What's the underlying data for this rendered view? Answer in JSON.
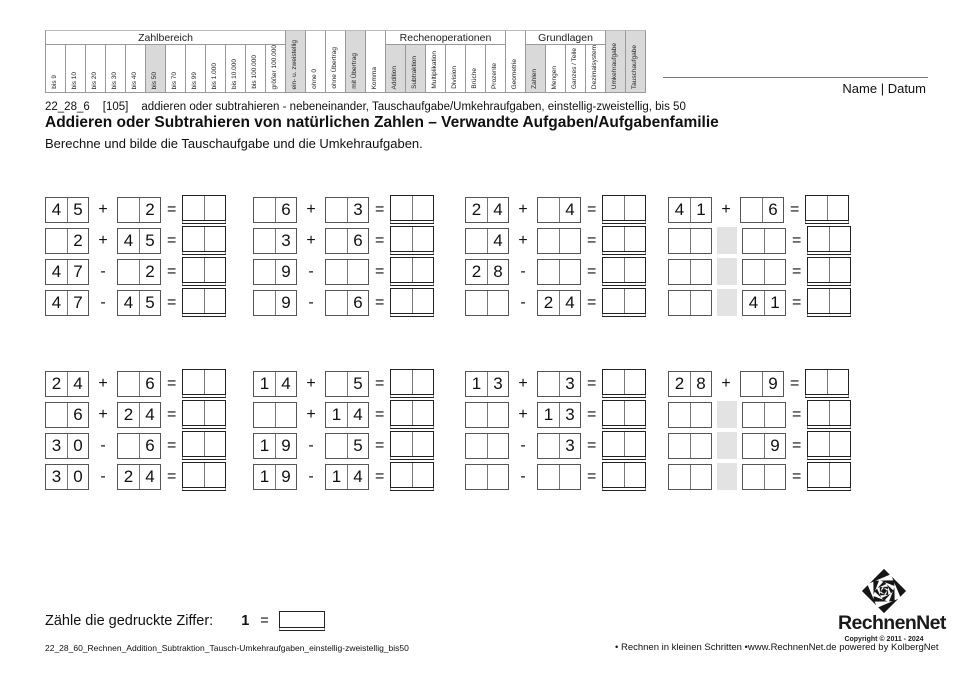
{
  "page": {
    "name_datum": "Name | Datum"
  },
  "symbols": {
    "equals": "="
  },
  "colors": {
    "highlight": "#d9d9d9",
    "operator_blank": "#e3e3e3"
  },
  "header_table": {
    "segments": [
      {
        "type": "group",
        "label": "Zahlbereich",
        "cols": [
          {
            "label": "bis 9"
          },
          {
            "label": "bis 10"
          },
          {
            "label": "bis 20"
          },
          {
            "label": "bis 30"
          },
          {
            "label": "bis 40"
          },
          {
            "label": "bis 50",
            "highlighted": true
          },
          {
            "label": "bis 70"
          },
          {
            "label": "bis 99"
          },
          {
            "label": "bis 1.000"
          },
          {
            "label": "bis 10.000"
          },
          {
            "label": "bis 100.000"
          },
          {
            "label": "größer 100.000"
          }
        ]
      },
      {
        "type": "tall",
        "label": "ein- u. zweistellig",
        "highlighted": true
      },
      {
        "type": "tall",
        "label": "ohne 0"
      },
      {
        "type": "tall",
        "label": "ohne Übertrag"
      },
      {
        "type": "tall",
        "label": "mit Übertrag",
        "highlighted": true
      },
      {
        "type": "tall",
        "label": "Komma"
      },
      {
        "type": "group",
        "label": "Rechenoperationen",
        "cols": [
          {
            "label": "Addition",
            "highlighted": true
          },
          {
            "label": "Subtraktion",
            "highlighted": true
          },
          {
            "label": "Multiplikation"
          },
          {
            "label": "Division"
          },
          {
            "label": "Brüche"
          },
          {
            "label": "Prozente"
          }
        ]
      },
      {
        "type": "tall",
        "label": "Geometrie"
      },
      {
        "type": "group",
        "label": "Grundlagen",
        "cols": [
          {
            "label": "Zahlen",
            "highlighted": true
          },
          {
            "label": "Mengen"
          },
          {
            "label": "Ganzes / Teile"
          },
          {
            "label": "Dezimalsystem"
          }
        ]
      },
      {
        "type": "tall",
        "label": "Umkehraufgabe",
        "highlighted": true
      },
      {
        "type": "tall",
        "label": "Tauschaufgabe",
        "highlighted": true
      }
    ]
  },
  "title_block": {
    "code": "22_28_6",
    "number": "[105]",
    "code_desc": "addieren oder subtrahieren - nebeneinander, Tauschaufgabe/Umkehraufgaben, einstellig-zweistellig, bis 50",
    "main_title": "Addieren oder Subtrahieren von natürlichen Zahlen – Verwandte Aufgaben/Aufgabenfamilie",
    "instruction": "Berechne und bilde die Tauschaufgabe und die Umkehraufgaben."
  },
  "problem_blocks": [
    {
      "families": [
        {
          "rows": [
            {
              "a": [
                "4",
                "5"
              ],
              "op": "+",
              "b": [
                "",
                "2"
              ]
            },
            {
              "a": [
                "",
                "2"
              ],
              "op": "+",
              "b": [
                "4",
                "5"
              ]
            },
            {
              "a": [
                "4",
                "7"
              ],
              "op": "-",
              "b": [
                "",
                "2"
              ]
            },
            {
              "a": [
                "4",
                "7"
              ],
              "op": "-",
              "b": [
                "4",
                "5"
              ]
            }
          ]
        },
        {
          "rows": [
            {
              "a": [
                "",
                "6"
              ],
              "op": "+",
              "b": [
                "",
                "3"
              ]
            },
            {
              "a": [
                "",
                "3"
              ],
              "op": "+",
              "b": [
                "",
                "6"
              ]
            },
            {
              "a": [
                "",
                "9"
              ],
              "op": "-",
              "b": [
                "",
                ""
              ]
            },
            {
              "a": [
                "",
                "9"
              ],
              "op": "-",
              "b": [
                "",
                "6"
              ]
            }
          ]
        },
        {
          "rows": [
            {
              "a": [
                "2",
                "4"
              ],
              "op": "+",
              "b": [
                "",
                "4"
              ]
            },
            {
              "a": [
                "",
                "4"
              ],
              "op": "+",
              "b": [
                "",
                ""
              ]
            },
            {
              "a": [
                "2",
                "8"
              ],
              "op": "-",
              "b": [
                "",
                ""
              ]
            },
            {
              "a": [
                "",
                ""
              ],
              "op": "-",
              "b": [
                "2",
                "4"
              ]
            }
          ]
        },
        {
          "rows": [
            {
              "a": [
                "4",
                "1"
              ],
              "op": "+",
              "b": [
                "",
                "6"
              ]
            },
            {
              "a": [
                "",
                ""
              ],
              "op": "?",
              "b": [
                "",
                ""
              ]
            },
            {
              "a": [
                "",
                ""
              ],
              "op": "?",
              "b": [
                "",
                ""
              ]
            },
            {
              "a": [
                "",
                ""
              ],
              "op": "?",
              "b": [
                "4",
                "1"
              ]
            }
          ]
        }
      ]
    },
    {
      "families": [
        {
          "rows": [
            {
              "a": [
                "2",
                "4"
              ],
              "op": "+",
              "b": [
                "",
                "6"
              ]
            },
            {
              "a": [
                "",
                "6"
              ],
              "op": "+",
              "b": [
                "2",
                "4"
              ]
            },
            {
              "a": [
                "3",
                "0"
              ],
              "op": "-",
              "b": [
                "",
                "6"
              ]
            },
            {
              "a": [
                "3",
                "0"
              ],
              "op": "-",
              "b": [
                "2",
                "4"
              ]
            }
          ]
        },
        {
          "rows": [
            {
              "a": [
                "1",
                "4"
              ],
              "op": "+",
              "b": [
                "",
                "5"
              ]
            },
            {
              "a": [
                "",
                ""
              ],
              "op": "+",
              "b": [
                "1",
                "4"
              ]
            },
            {
              "a": [
                "1",
                "9"
              ],
              "op": "-",
              "b": [
                "",
                "5"
              ]
            },
            {
              "a": [
                "1",
                "9"
              ],
              "op": "-",
              "b": [
                "1",
                "4"
              ]
            }
          ]
        },
        {
          "rows": [
            {
              "a": [
                "1",
                "3"
              ],
              "op": "+",
              "b": [
                "",
                "3"
              ]
            },
            {
              "a": [
                "",
                ""
              ],
              "op": "+",
              "b": [
                "1",
                "3"
              ]
            },
            {
              "a": [
                "",
                ""
              ],
              "op": "-",
              "b": [
                "",
                "3"
              ]
            },
            {
              "a": [
                "",
                ""
              ],
              "op": "-",
              "b": [
                "",
                ""
              ]
            }
          ]
        },
        {
          "rows": [
            {
              "a": [
                "2",
                "8"
              ],
              "op": "+",
              "b": [
                "",
                "9"
              ]
            },
            {
              "a": [
                "",
                ""
              ],
              "op": "?",
              "b": [
                "",
                ""
              ]
            },
            {
              "a": [
                "",
                ""
              ],
              "op": "?",
              "b": [
                "",
                "9"
              ]
            },
            {
              "a": [
                "",
                ""
              ],
              "op": "?",
              "b": [
                "",
                ""
              ]
            }
          ]
        }
      ]
    }
  ],
  "count_task": {
    "label": "Zähle die gedruckte Ziffer:",
    "digit": "1"
  },
  "footer": {
    "left": "22_28_60_Rechnen_Addition_Subtraktion_Tausch-Umkehraufgaben_einstellig-zweistellig_bis50",
    "middle": "•  Rechnen in kleinen Schritten  •",
    "right": "www.RechnenNet.de powered by KolbergNet"
  },
  "logo": {
    "name": "RechnenNet",
    "copyright": "Copyright © 2011 - 2024"
  }
}
